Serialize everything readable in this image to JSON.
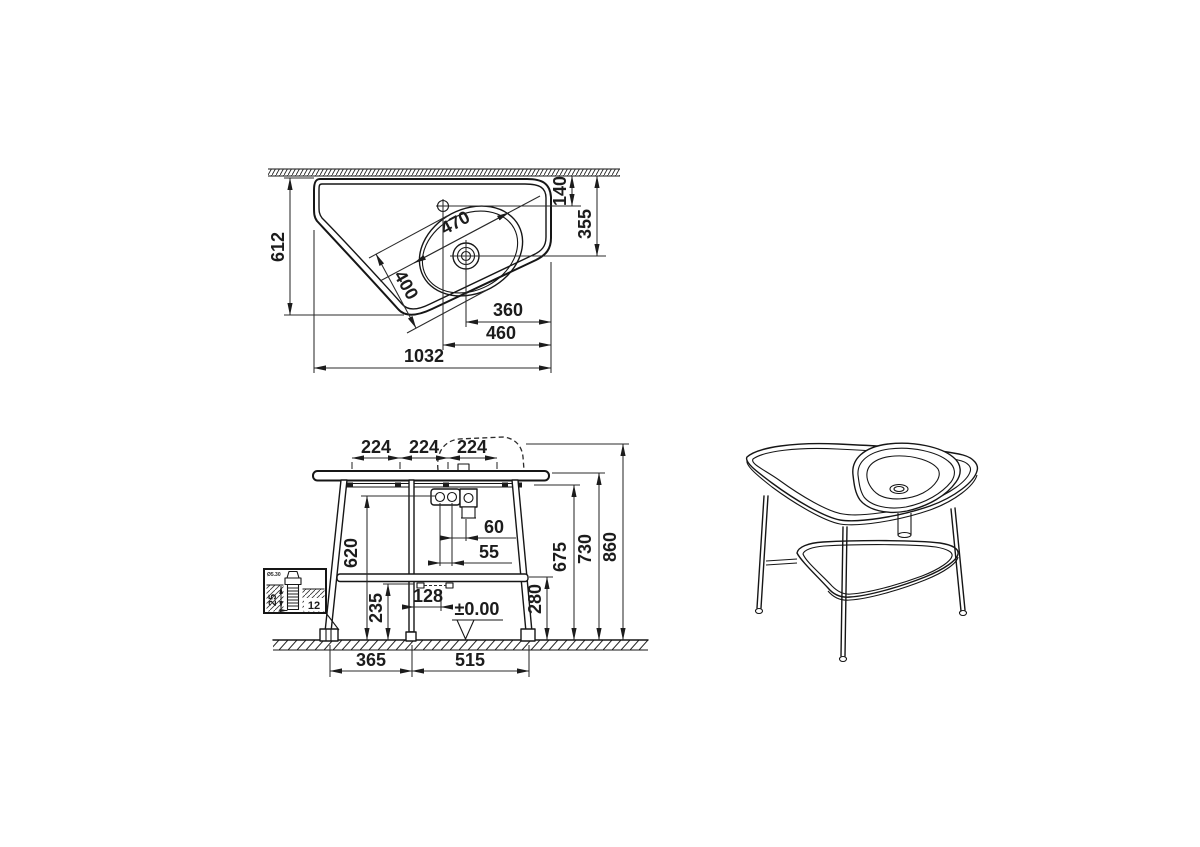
{
  "colors": {
    "line": "#1a1a1a",
    "background": "#ffffff"
  },
  "top_view": {
    "dims": {
      "depth": "612",
      "wall_to_tap": "140",
      "wall_to_drain": "355",
      "basin_length": "470",
      "basin_width": "400",
      "drain_offset": "360",
      "tap_offset": "460",
      "overall_width": "1032"
    }
  },
  "front_view": {
    "dims": {
      "pitch_a": "224",
      "pitch_b": "224",
      "pitch_c": "224",
      "tap_conn_height": "620",
      "under_shelf": "235",
      "rail_offset": "128",
      "drain_spacing": "60",
      "tap_spacing": "55",
      "shelf_height": "280",
      "frame_height": "675",
      "counter_height": "730",
      "overall_height": "860",
      "leg_span_left": "365",
      "leg_span_right": "515",
      "floor_level": "±0.00"
    }
  },
  "fixing_detail": {
    "embed_depth": "25",
    "plug_width": "12",
    "screw_label": "Ø5.30"
  }
}
